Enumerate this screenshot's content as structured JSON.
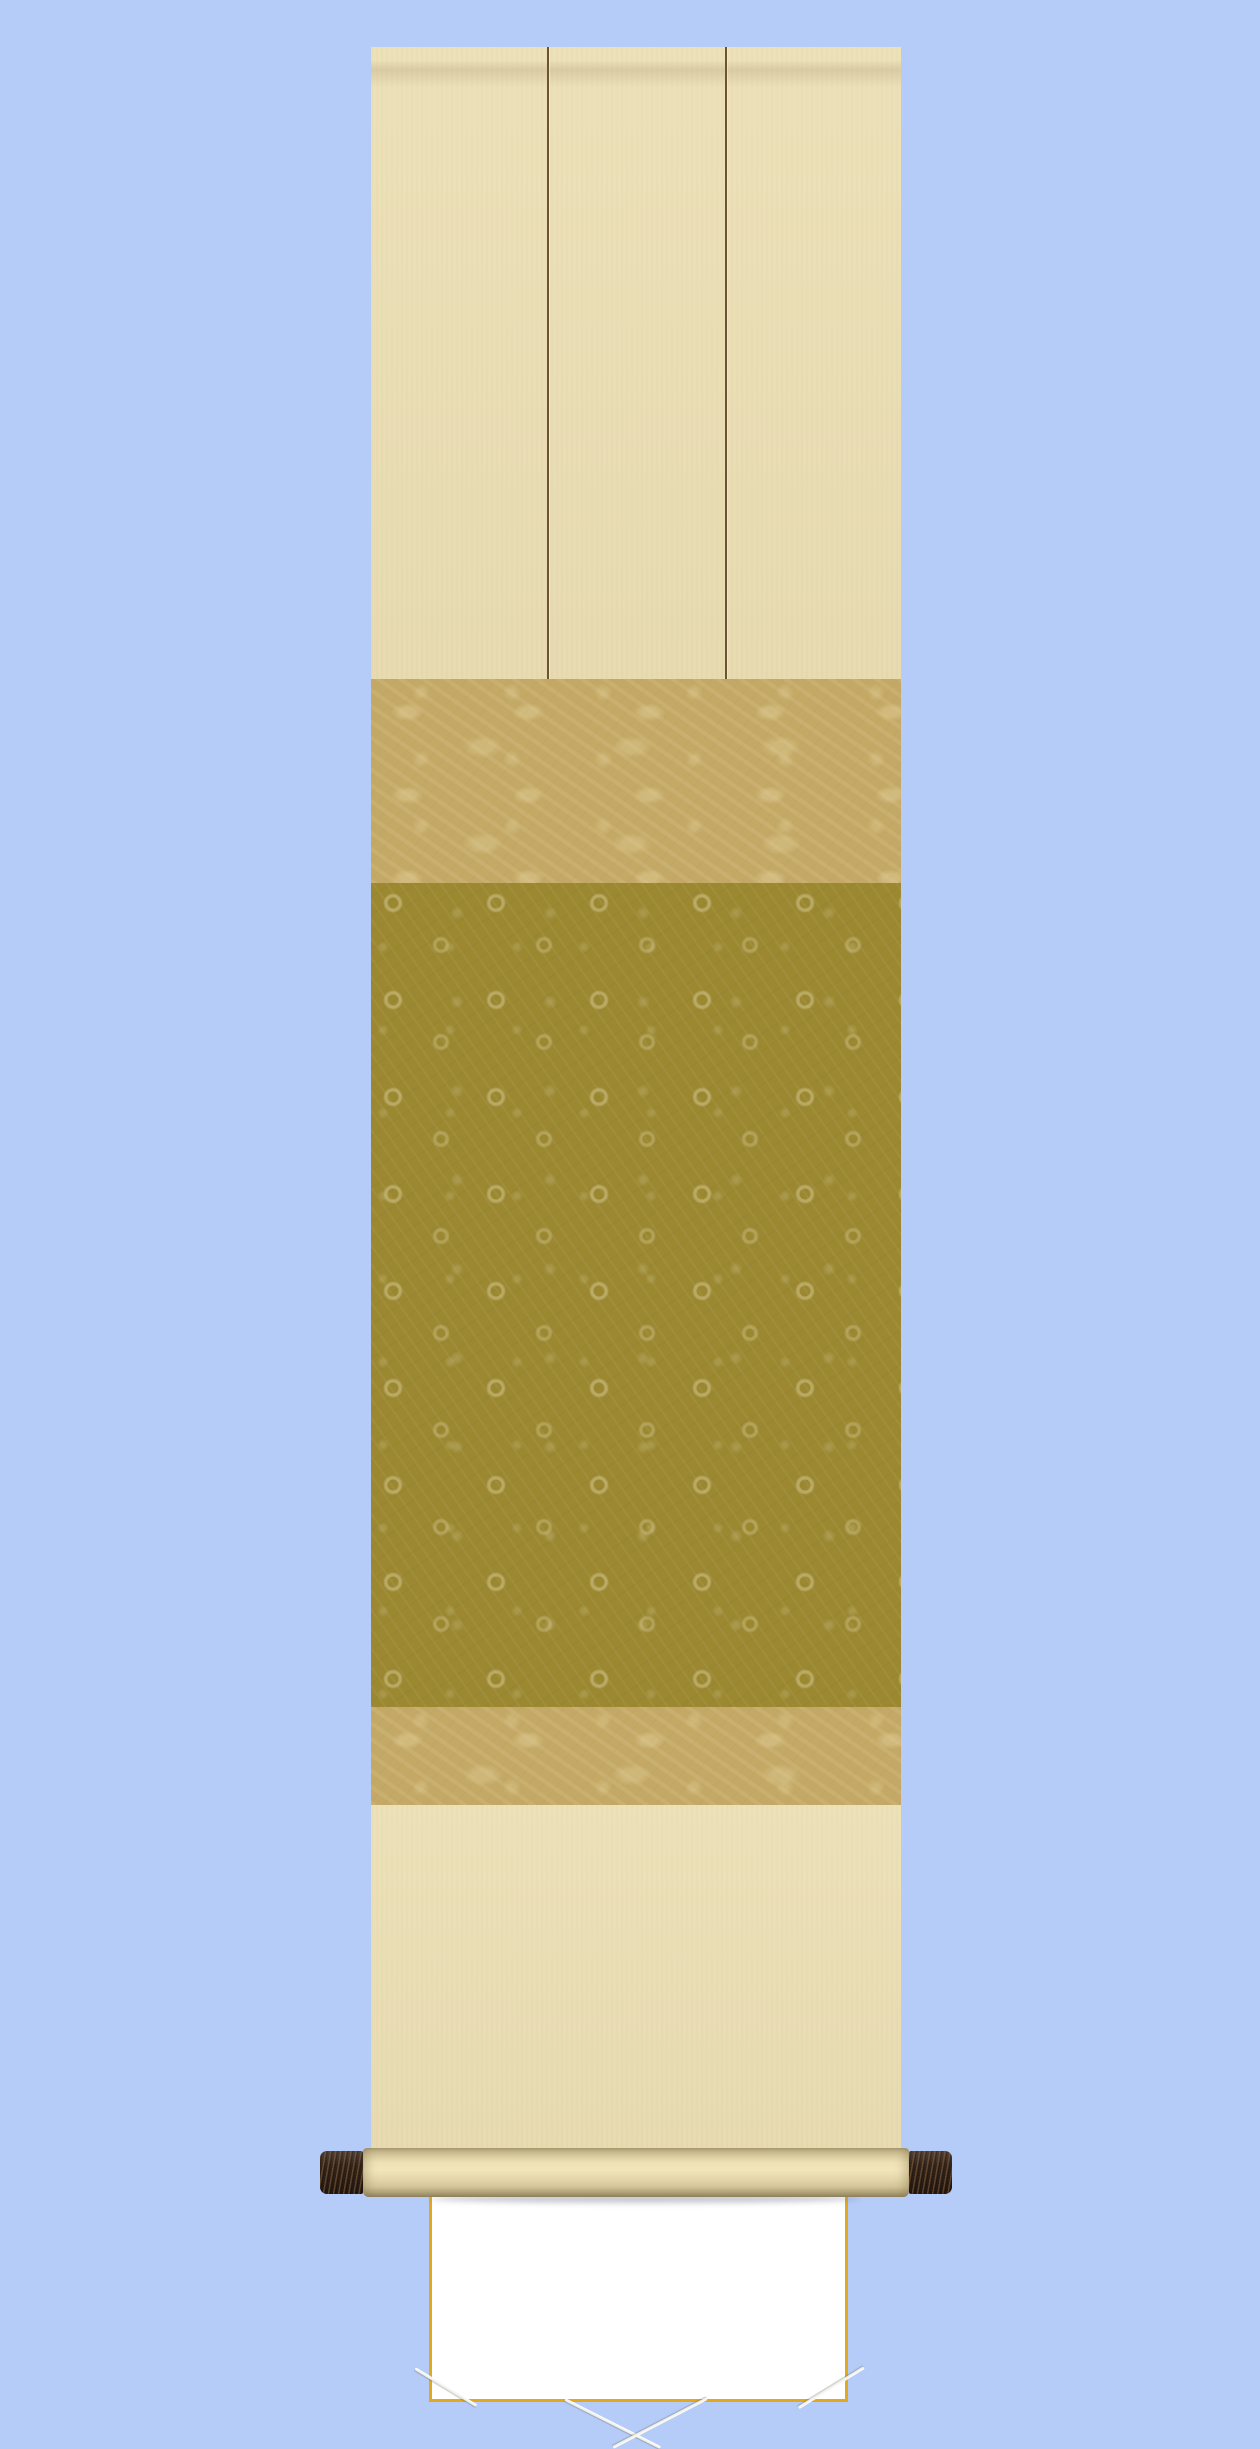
{
  "scene": {
    "description": "Japanese hanging scroll (kakejiku) mockup with a blank white shikishi board held by white cords, rolled bottom bar with dark wooden end knobs, on a plain light blue background",
    "background_color": "#b6ccf8",
    "parts": {
      "mount_fabric_cream": "#ecdfb4",
      "upper_band_tan": "#c4a966",
      "inner_mount_olive": "#9b8831",
      "pattern_highlight": "#cbb96f",
      "futai_line_brown": "#6b5334",
      "shikishi_white": "#ffffff",
      "shikishi_gold_border": "#e2a81f",
      "cord_white": "#fbfbfb",
      "roller_knob_brown": "#33241a",
      "roller_bottom_shade": "#968a64"
    },
    "part_labels": {
      "scroll_body": "hanging scroll body",
      "top_panel": "upper cream mounting panel with futai divider lines",
      "upper_band": "tan brocade accent band",
      "inner_mount": "olive floral damask inner mount",
      "shikishi": "blank white shikishi board with gold rim",
      "cords": "white mounting cords crossing each corner",
      "roller": "bottom roller bar with dark end knobs"
    }
  }
}
